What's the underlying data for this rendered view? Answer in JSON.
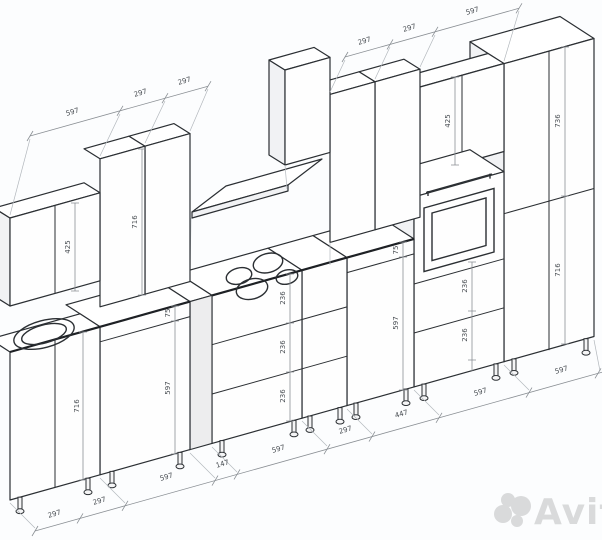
{
  "drawing": {
    "dim_chains": {
      "wall_left": [
        "597",
        "297",
        "297"
      ],
      "wall_right": [
        "297",
        "297",
        "597"
      ],
      "base_bottom": [
        "297",
        "297",
        "597",
        "147",
        "597",
        "297",
        "447",
        "597",
        "597"
      ]
    },
    "vertical_dims": {
      "wall_cab_low_height": "425",
      "wall_cab_tall_height": "716",
      "wall_cab_oven_height": "425",
      "sink_cab_height": "716",
      "cab2_drawer": "75",
      "cab2_door": "597",
      "cooktop_drawer_1": "236",
      "cooktop_drawer_2": "236",
      "cooktop_drawer_3": "236",
      "cab6_drawer": "75",
      "cab6_door": "597",
      "oven_drawer_1": "236",
      "oven_drawer_2": "236",
      "tall_upper": "736",
      "tall_lower": "716"
    }
  },
  "watermark": {
    "brand": "Avito"
  }
}
